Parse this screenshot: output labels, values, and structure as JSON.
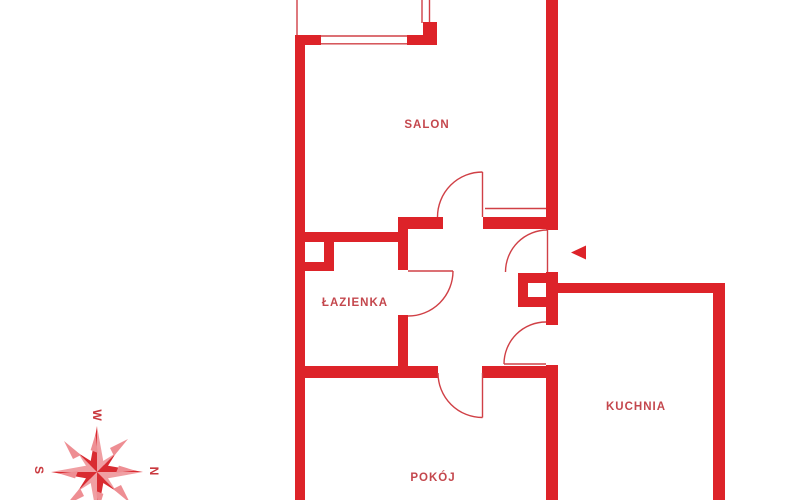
{
  "floorplan": {
    "title": "apartment-floor-plan",
    "rooms": [
      {
        "id": "salon",
        "label": "SALON"
      },
      {
        "id": "lazienka",
        "label": "ŁAZIENKA"
      },
      {
        "id": "kuchnia",
        "label": "KUCHNIA"
      },
      {
        "id": "pokoj",
        "label": "POKÓJ"
      }
    ],
    "compass": {
      "top": "W",
      "left": "S",
      "right": "N"
    },
    "entrance": {
      "marker": "left-pointing-arrow"
    },
    "colors": {
      "wall": "#dd2329",
      "thin_line": "#d04046",
      "label": "#c4474d",
      "compass_dark": "#d92b31",
      "compass_light": "#f09fa3",
      "background": "#ffffff"
    }
  }
}
